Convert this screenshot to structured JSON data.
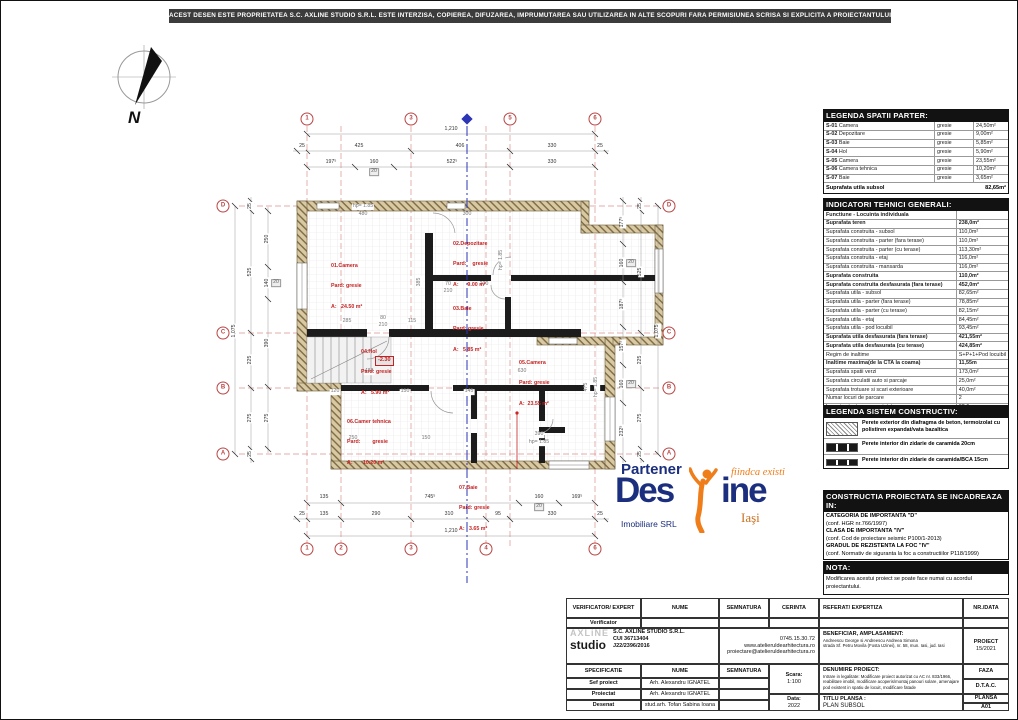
{
  "banner": "ACEST DESEN ESTE PROPRIETATEA S.C. AXLINE STUDIO S.R.L. ESTE INTERZISA, COPIEREA, DIFUZAREA, IMPRUMUTAREA SAU UTILIZAREA IN ALTE SCOPURI FARA PERMISIUNEA SCRISA SI EXPLICITA A PROIECTANTULUI.",
  "north_label": "N",
  "plan": {
    "level": "-2.30",
    "bubbles": [
      {
        "t": "1",
        "x": 306,
        "y": 118
      },
      {
        "t": "3",
        "x": 410,
        "y": 118
      },
      {
        "t": "5",
        "x": 509,
        "y": 118
      },
      {
        "t": "6",
        "x": 594,
        "y": 118
      },
      {
        "t": "1",
        "x": 306,
        "y": 548
      },
      {
        "t": "2",
        "x": 340,
        "y": 548
      },
      {
        "t": "3",
        "x": 410,
        "y": 548
      },
      {
        "t": "4",
        "x": 485,
        "y": 548
      },
      {
        "t": "6",
        "x": 594,
        "y": 548
      },
      {
        "t": "D",
        "x": 222,
        "y": 205
      },
      {
        "t": "C",
        "x": 222,
        "y": 332
      },
      {
        "t": "B",
        "x": 222,
        "y": 387
      },
      {
        "t": "A",
        "x": 222,
        "y": 453
      },
      {
        "t": "D",
        "x": 668,
        "y": 205
      },
      {
        "t": "C",
        "x": 668,
        "y": 332
      },
      {
        "t": "B",
        "x": 668,
        "y": 387
      },
      {
        "t": "A",
        "x": 668,
        "y": 453
      }
    ],
    "rooms": [
      {
        "l1": "01.Camera",
        "l2": "Pard: gresie",
        "l3": "A:   24.50 m²",
        "x": 330,
        "y": 248
      },
      {
        "l1": "02.Depozitare",
        "l2": "Pard:    gresie",
        "l3": "A:      9.00 m²",
        "x": 452,
        "y": 226
      },
      {
        "l1": "03.Baie",
        "l2": "Pard: gresie",
        "l3": "A:   5.85 m²",
        "x": 452,
        "y": 291
      },
      {
        "l1": "04.Hol",
        "l2": "Pard: gresie",
        "l3": "A:   5.90 m²",
        "x": 360,
        "y": 334
      },
      {
        "l1": "05.Camera",
        "l2": "Pard: gresie",
        "l3": "A:  23.55 m²",
        "x": 518,
        "y": 345
      },
      {
        "l1": "06.Camer tehnica",
        "l2": "Pard:        gresie",
        "l3": "A:       10.20 m²",
        "x": 346,
        "y": 404
      },
      {
        "l1": "07.Baie",
        "l2": "Pard: gresie",
        "l3": "A:   3.65 m²",
        "x": 458,
        "y": 470
      }
    ],
    "dims": [
      {
        "t": "1,210",
        "x": 450,
        "y": 129
      },
      {
        "t": "25",
        "x": 301,
        "y": 146
      },
      {
        "t": "425",
        "x": 358,
        "y": 146
      },
      {
        "t": "406",
        "x": 459,
        "y": 146
      },
      {
        "t": "330",
        "x": 551,
        "y": 146
      },
      {
        "t": "25",
        "x": 599,
        "y": 146
      },
      {
        "t": "197⁵",
        "x": 330,
        "y": 162
      },
      {
        "t": "160",
        "x": 373,
        "y": 162
      },
      {
        "t": "20",
        "x": 373,
        "y": 171,
        "cls": "box"
      },
      {
        "t": "522⁵",
        "x": 451,
        "y": 162
      },
      {
        "t": "330",
        "x": 551,
        "y": 162
      },
      {
        "t": "135",
        "x": 323,
        "y": 497
      },
      {
        "t": "745⁵",
        "x": 429,
        "y": 497
      },
      {
        "t": "160",
        "x": 538,
        "y": 497
      },
      {
        "t": "20",
        "x": 538,
        "y": 506,
        "cls": "box"
      },
      {
        "t": "169⁵",
        "x": 576,
        "y": 497
      },
      {
        "t": "25",
        "x": 301,
        "y": 514
      },
      {
        "t": "135",
        "x": 323,
        "y": 514
      },
      {
        "t": "290",
        "x": 375,
        "y": 514
      },
      {
        "t": "310",
        "x": 448,
        "y": 514
      },
      {
        "t": "95",
        "x": 497,
        "y": 514
      },
      {
        "t": "330",
        "x": 551,
        "y": 514
      },
      {
        "t": "25",
        "x": 599,
        "y": 514
      },
      {
        "t": "1,210",
        "x": 450,
        "y": 531
      },
      {
        "t": "1,075",
        "x": 234,
        "y": 330,
        "r": -90
      },
      {
        "t": "25",
        "x": 250,
        "y": 205,
        "r": -90
      },
      {
        "t": "525",
        "x": 250,
        "y": 271,
        "r": -90
      },
      {
        "t": "225",
        "x": 250,
        "y": 359,
        "r": -90
      },
      {
        "t": "275",
        "x": 250,
        "y": 417,
        "r": -90
      },
      {
        "t": "25",
        "x": 250,
        "y": 453,
        "r": -90
      },
      {
        "t": "250",
        "x": 267,
        "y": 238,
        "r": -90
      },
      {
        "t": "140",
        "x": 267,
        "y": 282,
        "r": -90
      },
      {
        "t": "20",
        "x": 275,
        "y": 282,
        "cls": "box"
      },
      {
        "t": "390",
        "x": 267,
        "y": 342,
        "r": -90
      },
      {
        "t": "275",
        "x": 267,
        "y": 417,
        "r": -90
      },
      {
        "t": "177⁵",
        "x": 622,
        "y": 221,
        "r": -90
      },
      {
        "t": "160",
        "x": 622,
        "y": 262,
        "r": -90
      },
      {
        "t": "20",
        "x": 630,
        "y": 262,
        "cls": "box"
      },
      {
        "t": "187⁵",
        "x": 622,
        "y": 303,
        "r": -90
      },
      {
        "t": "157⁵",
        "x": 622,
        "y": 345,
        "r": -90
      },
      {
        "t": "160",
        "x": 622,
        "y": 383,
        "r": -90
      },
      {
        "t": "20",
        "x": 630,
        "y": 383,
        "cls": "box"
      },
      {
        "t": "232⁵",
        "x": 622,
        "y": 430,
        "r": -90
      },
      {
        "t": "25",
        "x": 640,
        "y": 205,
        "r": -90
      },
      {
        "t": "525",
        "x": 640,
        "y": 271,
        "r": -90
      },
      {
        "t": "225",
        "x": 640,
        "y": 359,
        "r": -90
      },
      {
        "t": "275",
        "x": 640,
        "y": 417,
        "r": -90
      },
      {
        "t": "25",
        "x": 640,
        "y": 453,
        "r": -90
      },
      {
        "t": "1,075",
        "x": 657,
        "y": 330,
        "r": -90
      },
      {
        "t": "hp= 1.85",
        "x": 362,
        "y": 206,
        "cls": "inner"
      },
      {
        "t": "480",
        "x": 362,
        "y": 214,
        "cls": "inner"
      },
      {
        "t": "300",
        "x": 466,
        "y": 214,
        "cls": "inner"
      },
      {
        "t": "385",
        "x": 419,
        "y": 281,
        "r": -90,
        "cls": "inner"
      },
      {
        "t": "285",
        "x": 346,
        "y": 321,
        "cls": "inner"
      },
      {
        "t": "80",
        "x": 382,
        "y": 318,
        "cls": "inner"
      },
      {
        "t": "210",
        "x": 382,
        "y": 325,
        "cls": "inner"
      },
      {
        "t": "115",
        "x": 411,
        "y": 321,
        "cls": "inner"
      },
      {
        "t": "70",
        "x": 447,
        "y": 284,
        "cls": "inner"
      },
      {
        "t": "210",
        "x": 447,
        "y": 291,
        "cls": "inner"
      },
      {
        "t": "200",
        "x": 483,
        "y": 284,
        "cls": "inner"
      },
      {
        "t": "480",
        "x": 368,
        "y": 371,
        "cls": "inner"
      },
      {
        "t": "630",
        "x": 521,
        "y": 371,
        "cls": "inner"
      },
      {
        "t": "120",
        "x": 334,
        "y": 391,
        "cls": "inner"
      },
      {
        "t": "150",
        "x": 404,
        "y": 391,
        "cls": "inner"
      },
      {
        "t": "145",
        "x": 468,
        "y": 391,
        "cls": "inner"
      },
      {
        "t": "250",
        "x": 352,
        "y": 438,
        "cls": "inner"
      },
      {
        "t": "150",
        "x": 425,
        "y": 438,
        "cls": "inner"
      },
      {
        "t": "390",
        "x": 538,
        "y": 434,
        "cls": "inner"
      },
      {
        "t": "hp= 1.85",
        "x": 538,
        "y": 442,
        "cls": "inner"
      },
      {
        "t": "hp= 1.85",
        "x": 501,
        "y": 259,
        "r": -90,
        "cls": "inner"
      },
      {
        "t": "475",
        "x": 586,
        "y": 386,
        "r": -90,
        "cls": "inner"
      },
      {
        "t": "hp= 1.85",
        "x": 596,
        "y": 386,
        "r": -90,
        "cls": "inner"
      }
    ]
  },
  "legend_spatii": {
    "title": "LEGENDA SPATII PARTER:",
    "rows": [
      {
        "code": "S-01",
        "name": "Camera",
        "finish": "gresie",
        "area": "24,50m²"
      },
      {
        "code": "S-02",
        "name": "Depozitare",
        "finish": "gresie",
        "area": "9,00m²"
      },
      {
        "code": "S-03",
        "name": "Baie",
        "finish": "gresie",
        "area": "5,85m²"
      },
      {
        "code": "S-04",
        "name": "Hol",
        "finish": "gresie",
        "area": "5,90m²"
      },
      {
        "code": "S-05",
        "name": "Camera",
        "finish": "gresie",
        "area": "23,55m²"
      },
      {
        "code": "S-06",
        "name": "Camera tehnica",
        "finish": "gresie",
        "area": "10,20m²"
      },
      {
        "code": "S-07",
        "name": "Baie",
        "finish": "gresie",
        "area": "3,65m²"
      }
    ],
    "total_label": "Suprafata utila subsol",
    "total_value": "82,65m²"
  },
  "indicatori": {
    "title": "INDICATORI TEHNICI GENERALI:",
    "rows": [
      {
        "label": "Functiune - Locuinta individuala",
        "value": "",
        "bold": true
      },
      {
        "label": "Suprafata teren",
        "value": "238,0m²",
        "bold": true
      },
      {
        "label": "Suprafata construita - subsol",
        "value": "110,0m²"
      },
      {
        "label": "Suprafata construita - parter (fara terase)",
        "value": "110,0m²"
      },
      {
        "label": "Suprafata construita - parter (cu terase)",
        "value": "113,30m²"
      },
      {
        "label": "Suprafata construita - etaj",
        "value": "116,0m²"
      },
      {
        "label": "Suprafata construita - mansarda",
        "value": "116,0m²"
      },
      {
        "label": "Suprafata construita",
        "value": "110,0m²",
        "bold": true
      },
      {
        "label": "Suprafata construita desfasurata (fara terase)",
        "value": "452,0m²",
        "bold": true
      },
      {
        "label": "Suprafata utila - subsol",
        "value": "82,65m²"
      },
      {
        "label": "Suprafata utila - parter (fara terase)",
        "value": "78,85m²"
      },
      {
        "label": "Suprafata utila - parter (cu terase)",
        "value": "82,15m²"
      },
      {
        "label": "Suprafata utila - etaj",
        "value": "84,45m²"
      },
      {
        "label": "Suprafata utila - pod locuibil",
        "value": "93,45m²"
      },
      {
        "label": "Suprafata utila desfasurata (fara terase)",
        "value": "421,55m²",
        "bold": true
      },
      {
        "label": "Suprafata utila desfasurata (cu terase)",
        "value": "424,85m²",
        "bold": true
      },
      {
        "label": "Regim de inaltime",
        "value": "S+P+1+Pod locuibil"
      },
      {
        "label": "Inaltime maxima(de la CTA la coama)",
        "value": "11,55m",
        "bold": true
      },
      {
        "label": "Suprafata spatii verzi",
        "value": "173,0m²"
      },
      {
        "label": "Suprafata circulatii auto si parcaje",
        "value": "25,0m²"
      },
      {
        "label": "Suprafata trotuare si scari exterioare",
        "value": "40,0m²"
      },
      {
        "label": "Numar locuri de parcare",
        "value": "2"
      },
      {
        "label": "Imprejmuire teren proprietate",
        "value": "62,6m"
      },
      {
        "label": "Procentul de ocupare al terenului",
        "value": "46,21 %",
        "bold": true
      },
      {
        "label": "Coeficientul de utilizare al terenului",
        "value": "1,9",
        "bold": true
      }
    ]
  },
  "legend_sistem": {
    "title": "LEGENDA SISTEM CONSTRUCTIV:",
    "items": [
      "Perete exterior din diafragma de beton, termoizolat cu polistiren expandat/vata bazaltica",
      "Perete interior din zidarie de caramida 20cm",
      "Perete interior din zidarie de caramida/BCA 15cm"
    ]
  },
  "constructia": {
    "title": "CONSTRUCTIA PROIECTATA SE INCADREAZA IN:",
    "lines": [
      {
        "t": "CATEGORIA DE IMPORTANTA \"D\"",
        "bold": true
      },
      {
        "t": "(conf. HGR nr.766/1997)"
      },
      {
        "t": "CLASA DE IMPORTANTA \"IV\"",
        "bold": true
      },
      {
        "t": "(conf. Cod de proiectare seismic P100/1-2013)"
      },
      {
        "t": "GRADUL DE REZISTENTA LA FOC \"IV\"",
        "bold": true
      },
      {
        "t": "(conf. Normativ de siguranta la foc a constructiilor P118/1999)"
      }
    ]
  },
  "nota": {
    "title": "NOTA:",
    "text": "Modificarea acestui proiect se poate face numai cu acordul proiectantului."
  },
  "partner_logo": {
    "line1": "Partener",
    "big_left": "Des",
    "big_right": "ine",
    "tagline": "fiindca existi",
    "sub": "Imobiliare SRL",
    "city": "Iaşi"
  },
  "titleblock": {
    "h_verificator": "VERIFICATOR/ EXPERT",
    "h_nume": "NUME",
    "h_semnatura": "SEMNATURA",
    "h_cerinta": "CERINTA",
    "h_referat": "REFERAT/ EXPERTIZA",
    "h_nrdata": "NR./DATA",
    "verificator": "Verificator",
    "axline_name": "AXLiNE",
    "axline_sub": "studio",
    "company_1": "S.C. AXLINE STUDIO S.R.L.",
    "company_2": "CUI 36713404",
    "company_3": "J22/2396/2016",
    "phone": "0745.15.30.72",
    "web": "www.atelieruldearhitectura.ro",
    "email": "proiectare@atelieruldearhitectura.ro",
    "beneficiar_title": "BENEFICIAR, AMPLASAMENT:",
    "beneficiar_1": "Andreescu George si Andreescu Andreea Simona",
    "beneficiar_2": "strada Sf. Petru Movila (Fosta Uzinei), nr. 58, mun. Iasi, jud. Iasi",
    "proiect_label": "PROIECT",
    "proiect_value": "15/2021",
    "h_specificatie": "SPECIFICATIE",
    "scara_label": "Scara:",
    "scara_value": "1:100",
    "denumire_title": "DENUMIRE PROIECT:",
    "denumire_text": "Intrare in legalitate: Modificare proiect autorizat cu AC nr. 833/1966, reabilitare imobil, modificare acoperis/montaj panouri solare, amenajare pod existent in spatiu de locuit, modificare fatade",
    "faza_label": "FAZA",
    "faza_value": "D.T.A.C.",
    "sef_label": "Sef proiect",
    "sef_name": "Arh. Alexandru IGNATEL",
    "proiectat_label": "Proiectat",
    "proiectat_name": "Arh. Alexandru IGNATEL",
    "desenat_label": "Desenat",
    "desenat_name": "stud.arh. Tofan Sabina Ioana",
    "data_label": "Data:",
    "data_value": "2022",
    "titlu_label": "TITLU PLANSA :",
    "titlu_value": "PLAN SUBSOL",
    "plansa_label": "PLANSA",
    "plansa_value": "A01"
  }
}
